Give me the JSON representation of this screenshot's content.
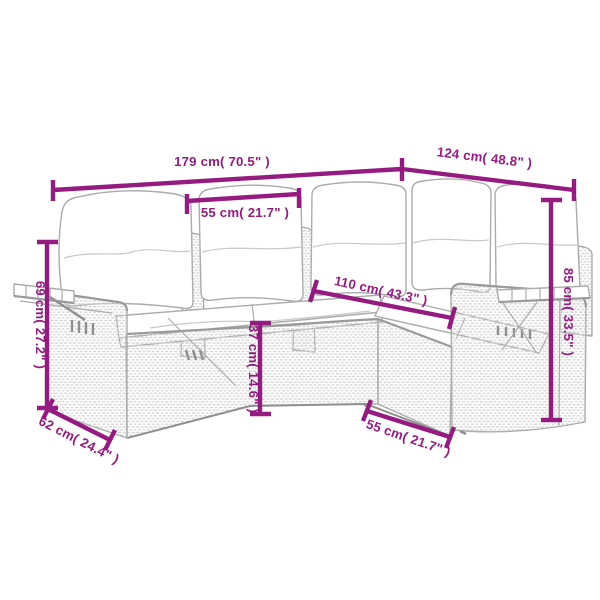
{
  "figure": {
    "kind": "product-dimension-diagram",
    "units": [
      "cm",
      "inch"
    ]
  },
  "colors": {
    "accent": "#951B81",
    "sketch": "#acacac",
    "sketchDark": "#8f8f8f",
    "texture": "#d6d6d6"
  },
  "dims": [
    {
      "id": "total-width",
      "label": "179 cm( 70.5\" )"
    },
    {
      "id": "total-depth-right",
      "label": "124 cm( 48.8\" )"
    },
    {
      "id": "seat-width",
      "label": "55 cm( 21.7\" )"
    },
    {
      "id": "inner-corner-length",
      "label": "110 cm( 43.3\" )"
    },
    {
      "id": "armrest-height",
      "label": "69 cm( 27.2\" )"
    },
    {
      "id": "depth-left",
      "label": "62 cm( 24.4\" )"
    },
    {
      "id": "seat-height",
      "label": "37 cm( 14.6\" )"
    },
    {
      "id": "right-seat-depth",
      "label": "55 cm( 21.7\" )"
    },
    {
      "id": "back-height",
      "label": "85 cm( 33.5\" )"
    }
  ]
}
